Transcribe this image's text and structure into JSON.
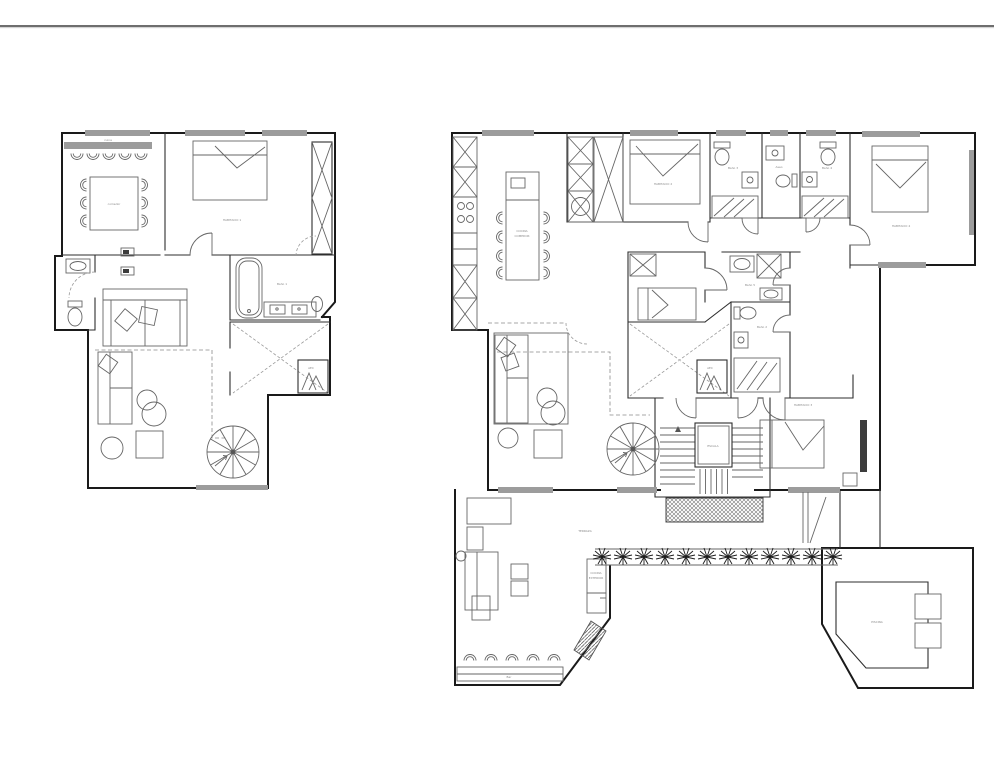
{
  "page": {
    "background": "#ffffff",
    "top_rule_color": "#6e6e6e",
    "wall_color": "#1a1a1a",
    "furniture_color": "#666666",
    "label_color": "#8a8a8a",
    "window_band_color": "#9c9c9c"
  },
  "left_plan": {
    "labels": {
      "counter": "cuina",
      "dining": "comedor",
      "bedroom": "HABITACIO 1",
      "bath": "Baño 1",
      "closet": "AEC"
    }
  },
  "right_plan": {
    "labels": {
      "kitchen_line1": "COCINA",
      "kitchen_line2": "COMEDOR",
      "bedroom2": "HABITACIO 2",
      "bedroom3": "HABITACIO 3",
      "bedroom4": "HABITACIO 4",
      "bath3": "Baño 3",
      "aseo": "Aseo",
      "bath4": "Baño 4",
      "bath5": "Baño 5",
      "bath2": "Baño 2",
      "closet": "AEC",
      "stairs": "ESCALA",
      "terrace": "TERRAZA",
      "outdoor_kitchen_line1": "COCINA",
      "outdoor_kitchen_line2": "EXTERIOR",
      "bar": "Bar",
      "pool": "PISCINA"
    }
  }
}
